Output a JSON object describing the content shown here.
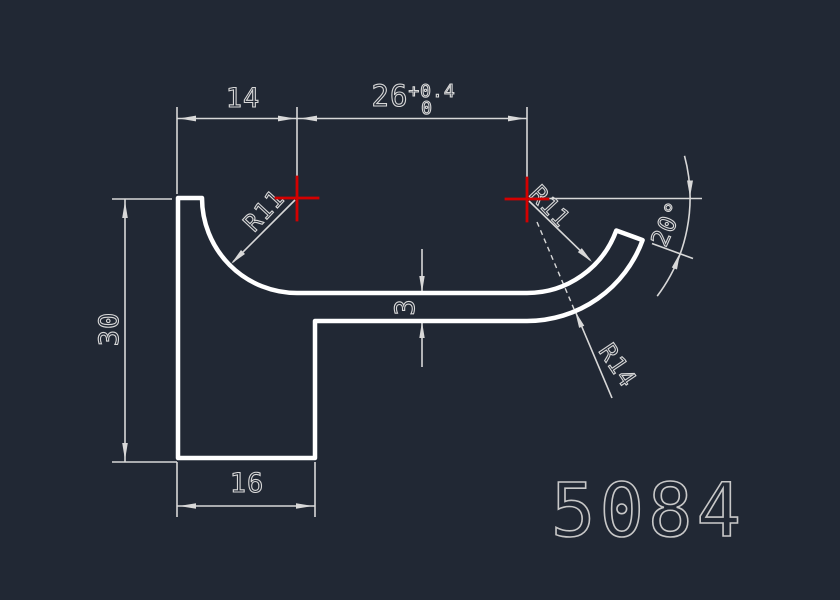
{
  "canvas": {
    "bg": "#212834",
    "profile_color": "#ffffff",
    "dim_color": "#d8d8d8",
    "center_mark_color": "#d40000",
    "part_number_color": "#c8c8c8"
  },
  "dimensions": {
    "top_left_width": "14",
    "top_right_width": "26",
    "top_right_tol_upper": "+0.4",
    "top_right_tol_lower": "0",
    "left_height": "30",
    "flange_thickness": "3",
    "base_width": "16",
    "inner_radius_left": "R11",
    "inner_radius_right": "R11",
    "outer_radius": "R14",
    "lip_angle": "20°"
  },
  "part_number": "5084"
}
